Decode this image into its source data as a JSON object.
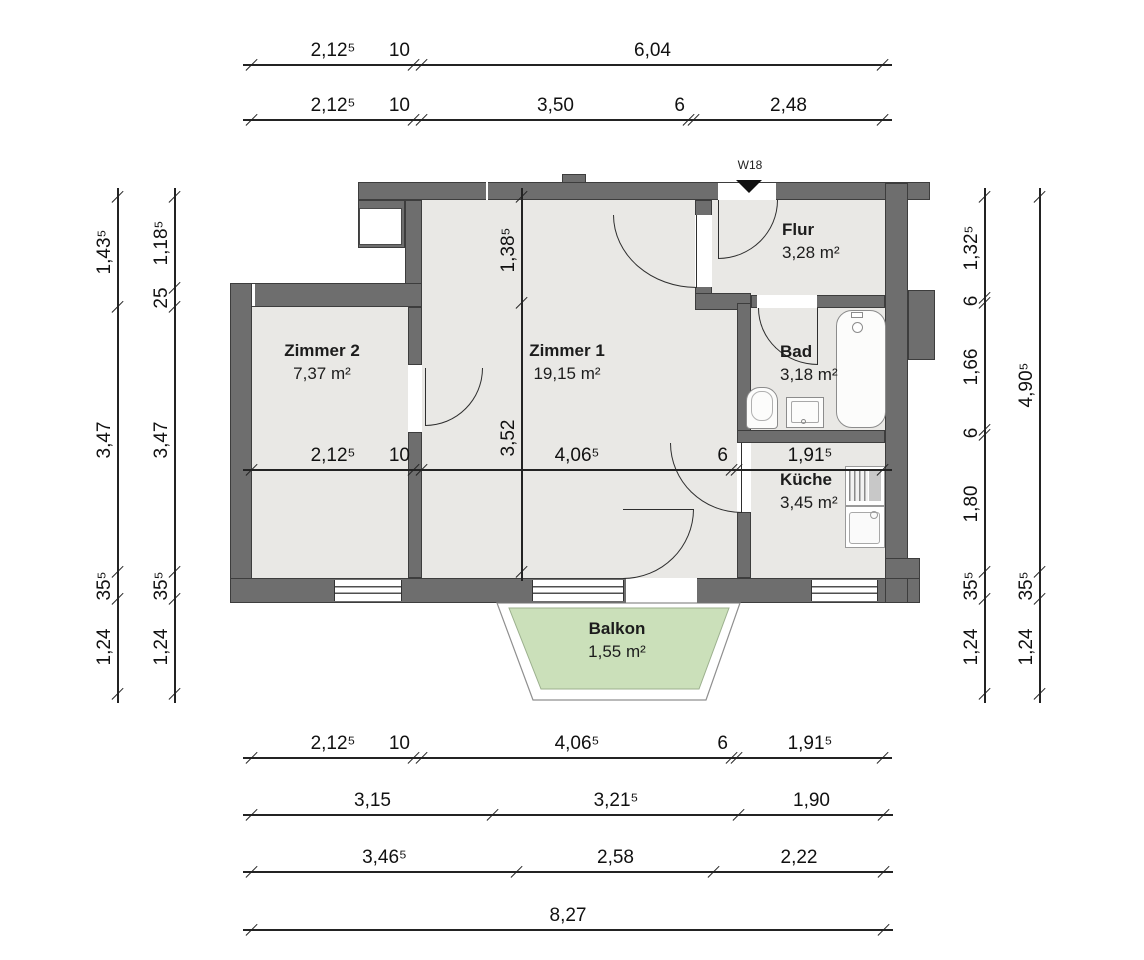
{
  "plan": {
    "entrance": {
      "label": "W18"
    },
    "rooms": [
      {
        "id": "zimmer2",
        "name": "Zimmer 2",
        "area": "7,37 m²"
      },
      {
        "id": "zimmer1",
        "name": "Zimmer 1",
        "area": "19,15 m²"
      },
      {
        "id": "flur",
        "name": "Flur",
        "area": "3,28 m²"
      },
      {
        "id": "bad",
        "name": "Bad",
        "area": "3,18 m²"
      },
      {
        "id": "kueche",
        "name": "Küche",
        "area": "3,45 m²"
      },
      {
        "id": "balkon",
        "name": "Balkon",
        "area": "1,55 m²"
      }
    ],
    "fixtures": [
      "bathtub",
      "toilet",
      "washbasin",
      "stove",
      "kitchen-sink"
    ],
    "colors": {
      "wall": "#6e6e6e",
      "floor": "#e9e8e5",
      "balcony_green": "#cbe0ba",
      "line": "#1f1f1f"
    }
  },
  "dimensions": {
    "top_row1": [
      "2,12⁵",
      "10",
      "6,04"
    ],
    "top_row2": [
      "2,12⁵",
      "10",
      "3,50",
      "6",
      "2,48"
    ],
    "interior_horizontal": [
      "2,12⁵",
      "10",
      "4,06⁵",
      "6",
      "1,91⁵"
    ],
    "interior_vertical": [
      "1,38⁵",
      "3,52"
    ],
    "bottom_row1": [
      "2,12⁵",
      "10",
      "4,06⁵",
      "6",
      "1,91⁵"
    ],
    "bottom_row2": [
      "3,15",
      "3,21⁵",
      "1,90"
    ],
    "bottom_row3": [
      "3,46⁵",
      "2,58",
      "2,22"
    ],
    "bottom_row4": [
      "8,27"
    ],
    "left_outer": [
      "1,43⁵",
      "3,47",
      "35⁵",
      "1,24"
    ],
    "left_inner": [
      "1,18⁵",
      "25",
      "3,47",
      "35⁵",
      "1,24"
    ],
    "right_inner": [
      "1,32⁵",
      "6",
      "1,66",
      "6",
      "1,80",
      "35⁵",
      "1,24"
    ],
    "right_outer": [
      "4,90⁵",
      "35⁵",
      "1,24"
    ]
  }
}
